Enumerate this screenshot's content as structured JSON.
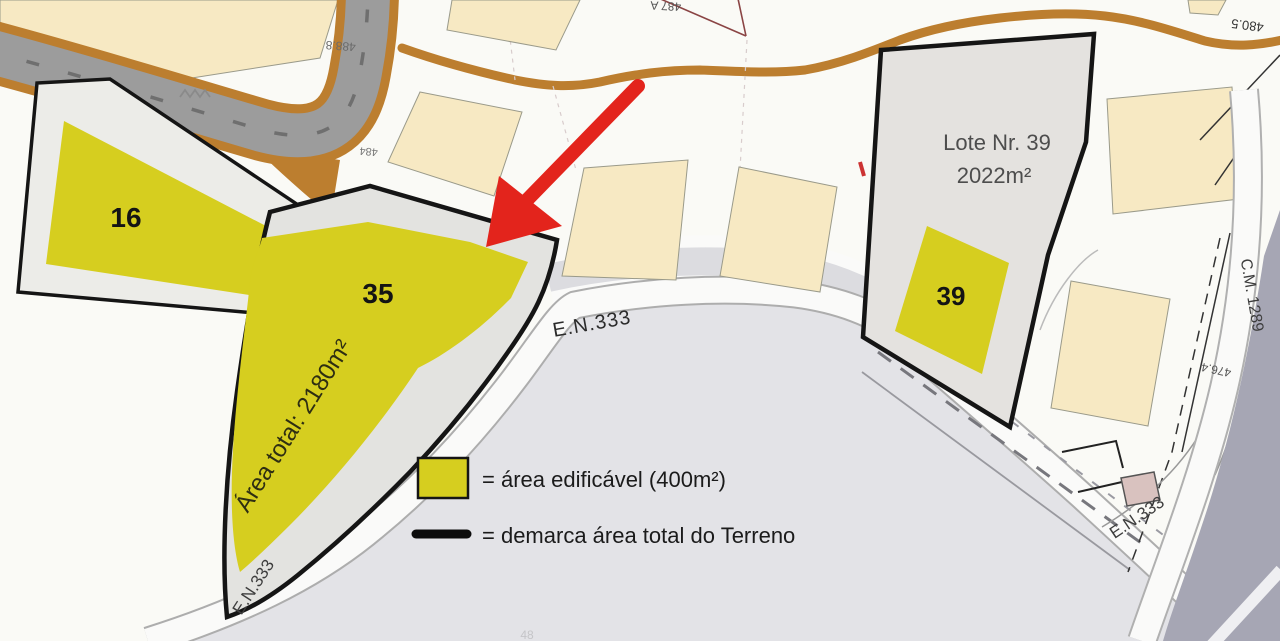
{
  "lots": {
    "lot16": {
      "label": "16"
    },
    "lot35": {
      "label": "35",
      "area_total": "Área total: 2180m²"
    },
    "lot39": {
      "label": "39",
      "name": "Lote Nr. 39",
      "area": "2022m²"
    }
  },
  "roads": {
    "en333": "E.N.333",
    "cm1289": "C.M. 1289"
  },
  "elevations": {
    "top_left": "488.8",
    "top_right": "480.5",
    "right": "476.4",
    "top_center": "487 A",
    "branch": "484",
    "bottom": "48"
  },
  "legend": {
    "buildable": "= área edificável (400m²)",
    "terrain": "= demarca área total do Terreno"
  },
  "colors": {
    "buildable_yellow": "#D6CE1F",
    "outline_black": "#151515",
    "beige_lot": "#F7E9C3",
    "road_gray": "#9C9C9C",
    "shoulder_brown": "#BC7E2F",
    "asphalt_light": "#E3E3E7",
    "dark_area": "#A6A6B4",
    "arrow_red": "#E3241C"
  }
}
